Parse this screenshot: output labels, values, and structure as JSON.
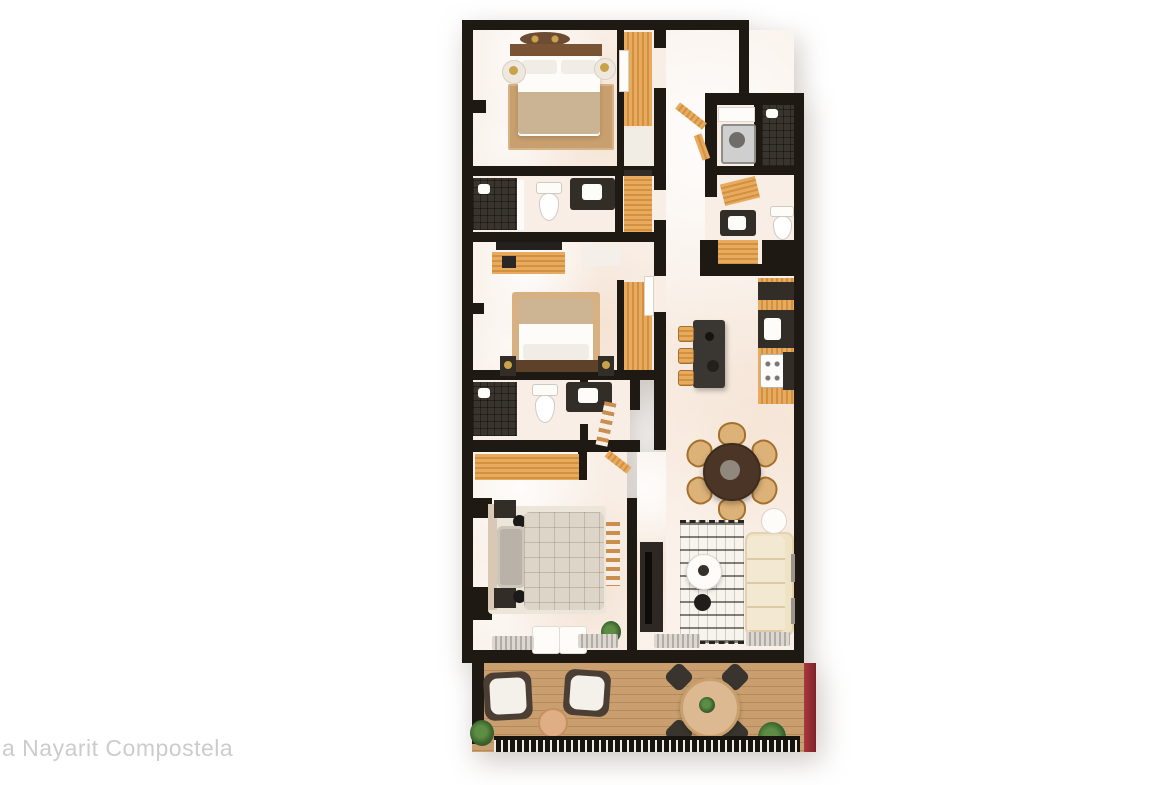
{
  "watermark": {
    "text": "a Nayarit Compostela",
    "color": "#cccccc"
  },
  "scene": {
    "type": "3d-top-down-floorplan-render",
    "description": "Photorealistic top-view rendering of a three-bedroom apartment unit with open kitchen, dining, living room and furnished terrace",
    "rooms": [
      "master-bedroom",
      "master-closet",
      "bathroom-1",
      "bedroom-2",
      "closet-2",
      "bathroom-2",
      "bedroom-3",
      "entry-hall",
      "laundry",
      "guest-bathroom",
      "kitchen",
      "dining-area",
      "living-room",
      "terrace"
    ],
    "furniture": [
      "double-bed-1",
      "double-bed-2",
      "double-bed-3",
      "nightstands",
      "wardrobes",
      "toilets",
      "vanities",
      "showers",
      "washer",
      "kitchen-counter",
      "kitchen-island",
      "bar-stools",
      "round-dining-table-6-chairs",
      "sofa",
      "coffee-table",
      "tv-console",
      "boho-rug",
      "terrace-lounge-chairs",
      "terrace-side-table",
      "terrace-table-4-chairs",
      "potted-plants",
      "terrace-railing"
    ]
  },
  "colors": {
    "background": "#ffffff",
    "walls": "#1f1913",
    "floor_marble": "#f8eee5",
    "wood_cabinetry": "#d2913f",
    "dark_counters": "#332d27",
    "shower_tile": "#3a342e",
    "deck_wood": "#c99f70",
    "accent_wall_red": "#9a303a",
    "sofa_cream": "#efe3c6",
    "dining_table_brown": "#4a3526",
    "bedroom_rug_tan": "#c89f6f",
    "watermark_gray": "#cccccc"
  }
}
